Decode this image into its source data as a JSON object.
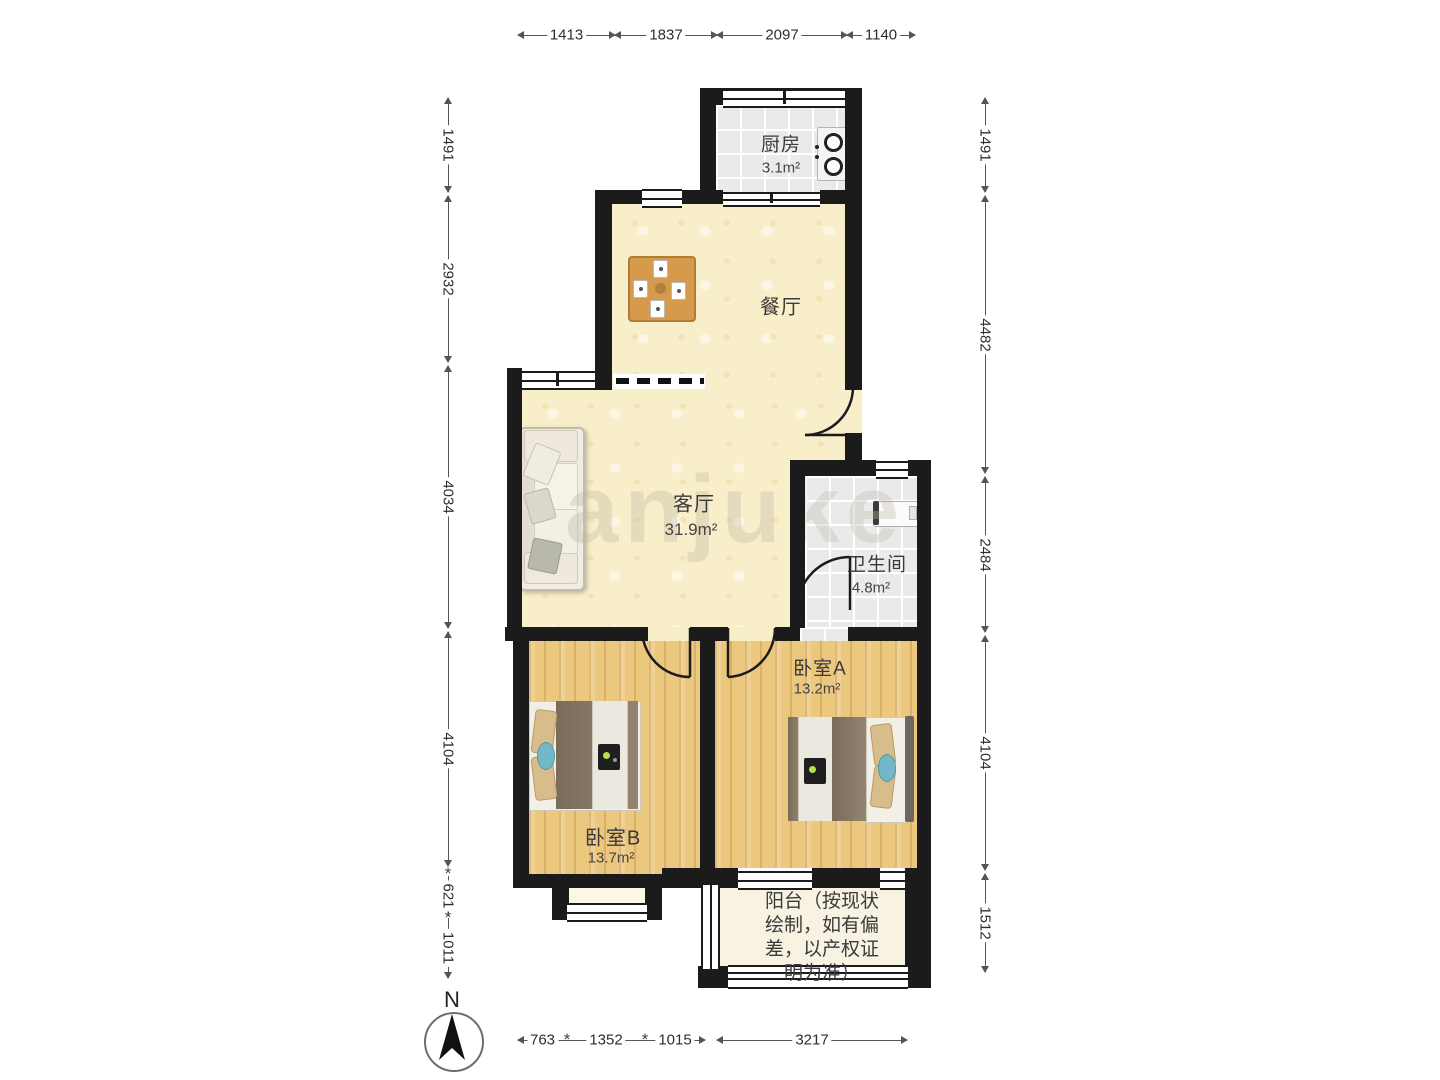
{
  "rooms": {
    "kitchen": {
      "name": "厨房",
      "area": "3.1m²"
    },
    "dining": {
      "name": "餐厅"
    },
    "living": {
      "name": "客厅",
      "area": "31.9m²"
    },
    "bathroom": {
      "name": "卫生间",
      "area": "4.8m²"
    },
    "bedroomA": {
      "name": "卧室A",
      "area": "13.2m²"
    },
    "bedroomB": {
      "name": "卧室B",
      "area": "13.7m²"
    },
    "balcony": {
      "lines": [
        "阳台（按现状",
        "绘制，如有偏",
        "差，以产权证",
        "明为准）"
      ]
    }
  },
  "dimensions": {
    "top": [
      "1413",
      "1837",
      "2097",
      "1140"
    ],
    "bottom": [
      "763",
      "1352",
      "1015",
      "3217"
    ],
    "left": [
      "1491",
      "2932",
      "4034",
      "4104",
      "621",
      "1011"
    ],
    "right": [
      "1491",
      "4482",
      "2484",
      "4104",
      "1512"
    ],
    "tick": "*"
  },
  "compass": {
    "north_label": "N"
  },
  "watermark": "anjuke"
}
